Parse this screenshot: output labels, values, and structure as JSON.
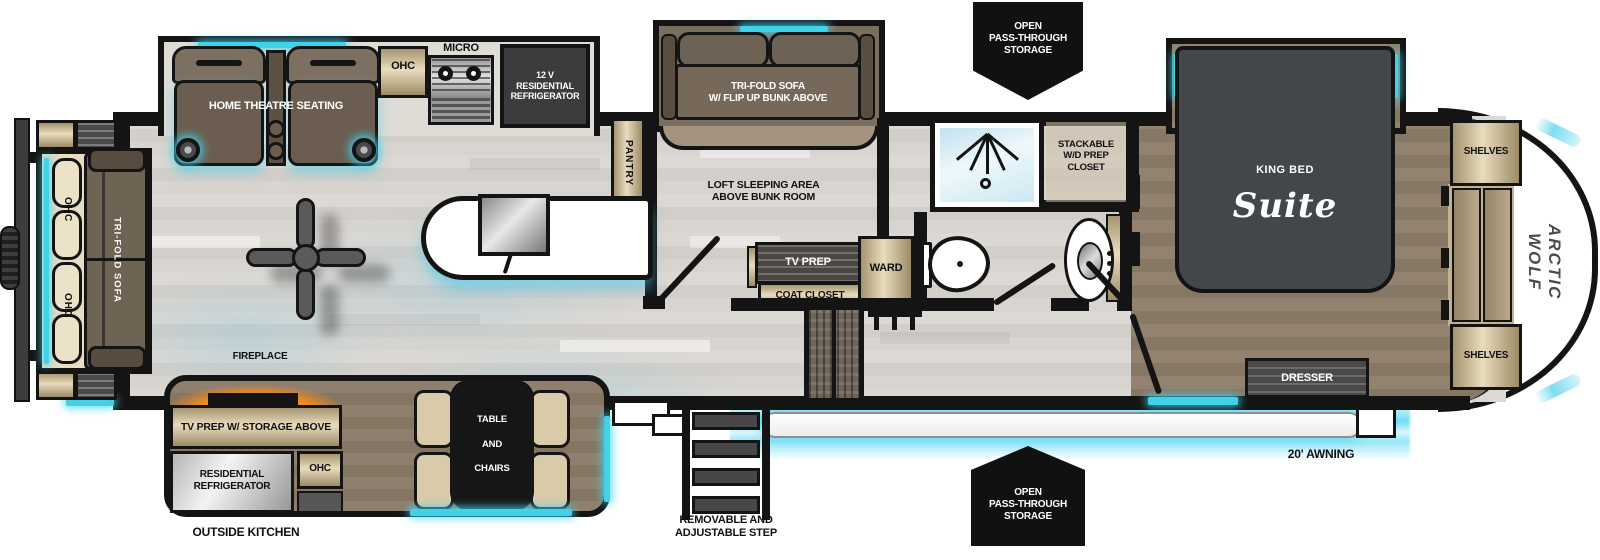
{
  "exterior": {
    "brand": "ARCTIC WOLF",
    "awning": "20' AWNING",
    "step": "REMOVABLE AND\nADJUSTABLE STEP",
    "storage_top": "OPEN\nPASS-THROUGH\nSTORAGE",
    "storage_bottom": "OPEN\nPASS-THROUGH\nSTORAGE",
    "outside_kitchen_title": "OUTSIDE KITCHEN"
  },
  "living": {
    "home_theatre": "HOME THEATRE SEATING",
    "fireplace": "FIREPLACE",
    "tri_fold_sofa": "TRI-FOLD SOFA",
    "ohc_upper": "OHC",
    "ohc_lower": "OHC"
  },
  "kitchen": {
    "ohc": "OHC",
    "micro": "MICRO",
    "refrigerator": "12 V\nRESIDENTIAL\nREFRIGERATOR",
    "pantry": "PANTRY",
    "pantry_ohc": "OHC"
  },
  "bunk_room": {
    "bunk_sofa": "TRI-FOLD SOFA\nW/ FLIP UP BUNK ABOVE",
    "loft": "LOFT SLEEPING AREA\nABOVE BUNK ROOM",
    "tv_prep": "TV PREP",
    "coat_closet": "COAT CLOSET",
    "ward": "WARD"
  },
  "bathroom": {
    "wd_closet": "STACKABLE\nW/D PREP\nCLOSET"
  },
  "bedroom": {
    "king_bed": "KING BED",
    "suite": "Suite",
    "dresser": "DRESSER",
    "shelves_top": "SHELVES",
    "shelves_bottom": "SHELVES"
  },
  "outside_kitchen": {
    "tv_prep": "TV PREP W/ STORAGE ABOVE",
    "refrigerator": "RESIDENTIAL\nREFRIGERATOR",
    "ohc": "OHC",
    "table": "TABLE\nAND\nCHAIRS"
  },
  "colors": {
    "accent_cyan": "#3fd2e8",
    "floor_light": "#d8d4cf",
    "floor_brown": "#8c7d6f",
    "cabinet_tan": "#e0d2b2",
    "cabinet_dark": "#3c3c3c",
    "sofa_brown": "#6e6254",
    "bed_gray": "#43464a",
    "shower_blue": "#cfe8f3",
    "fireplace_orange": "#ee8a1e",
    "wall_black": "#141414"
  }
}
